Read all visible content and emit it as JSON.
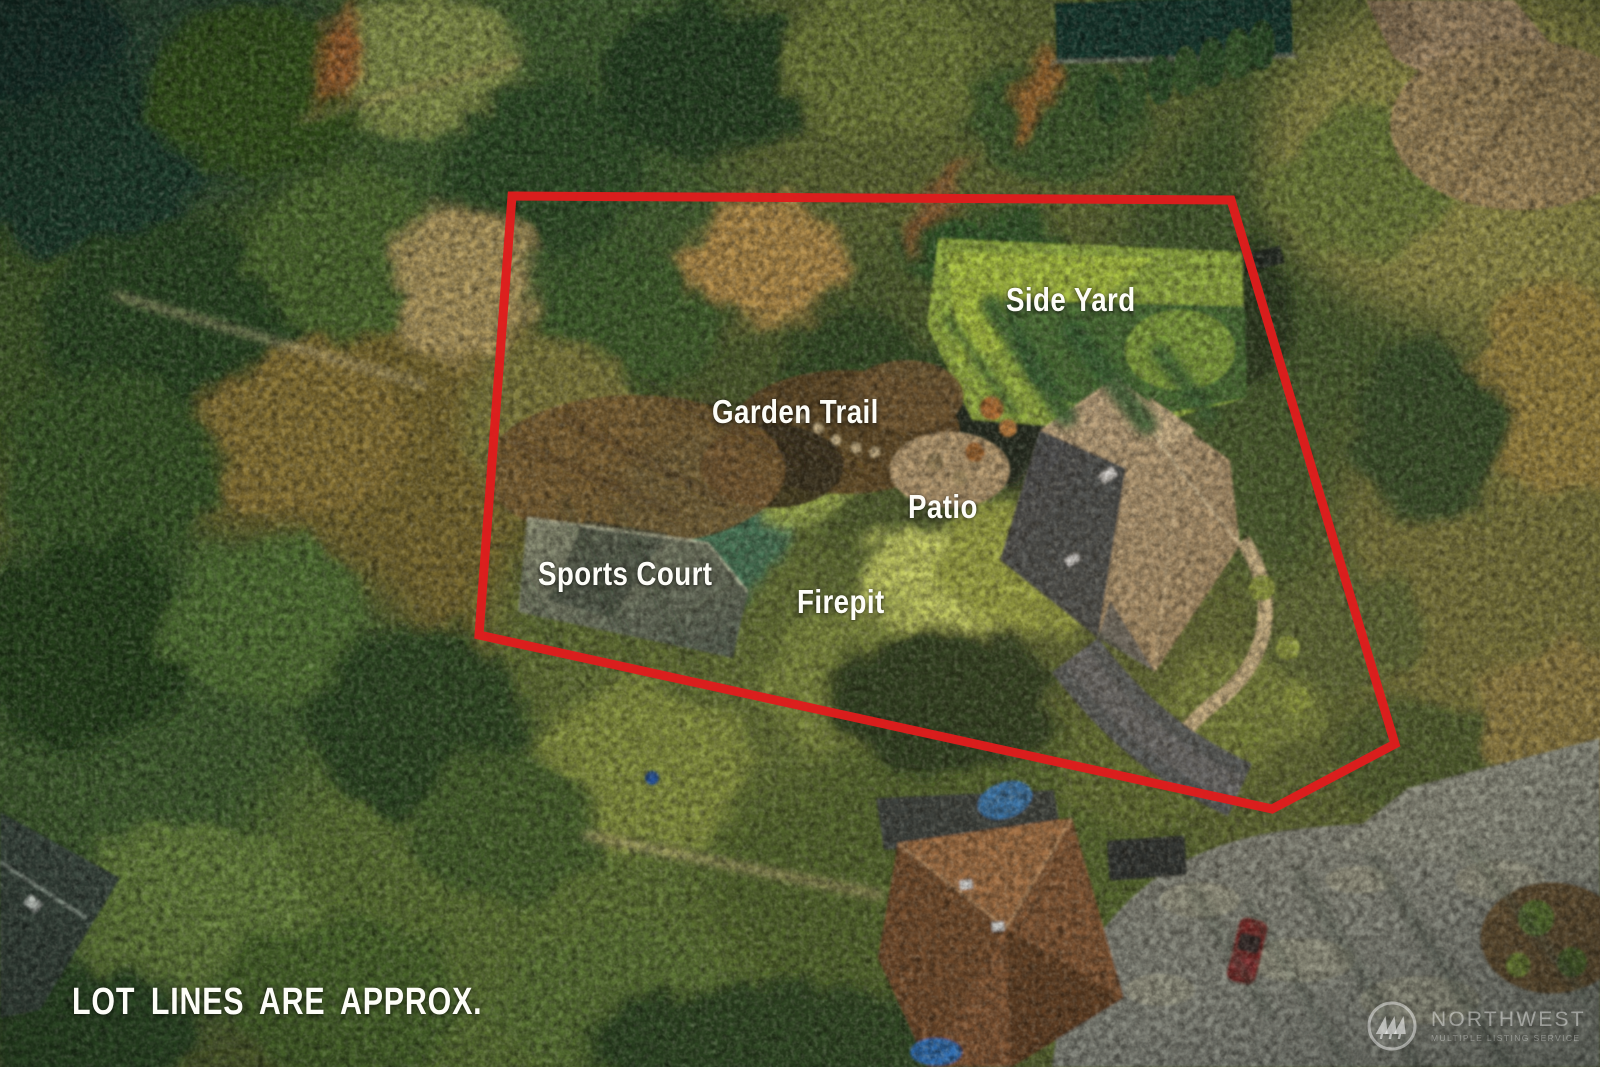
{
  "image_type": "aerial-property-listing-photo",
  "annotations": {
    "labels": [
      {
        "id": "side-yard",
        "text": "Side Yard"
      },
      {
        "id": "garden-trail",
        "text": "Garden Trail"
      },
      {
        "id": "patio",
        "text": "Patio"
      },
      {
        "id": "sports-court",
        "text": "Sports Court"
      },
      {
        "id": "firepit",
        "text": "Firepit"
      }
    ],
    "disclaimer": "LOT LINES ARE APPROX.",
    "lot_line_color": "#df1d1d",
    "label_text_color": "#ffffff"
  },
  "watermark": {
    "icon": "evergreen-trees-circle-icon",
    "title": "NORTHWEST",
    "subtitle": "MULTIPLE LISTING SERVICE"
  },
  "scene": {
    "description": "Aerial drone view of a forested residential lot outlined with a red approximate lot line; inside the lot are a side yard lawn, garden trail, patio, firepit, sports court and a large house with tan hip roof and curved driveway; neighboring homes, a pool, a parked car and a cul-de-sac road are visible around the edges.",
    "palette": {
      "forest_dark": "#24401f",
      "forest_mid": "#4f6c2c",
      "forest_gold": "#b28c49",
      "lawn_sunlit": "#a9c441",
      "lawn_shadow": "#2d5a31",
      "roof_tan": "#b49b7b",
      "roof_shadow": "#3b424c",
      "asphalt_road": "#7d827c",
      "neighbor_roof_brown": "#7c5133",
      "sports_court": "#4b5950"
    }
  }
}
